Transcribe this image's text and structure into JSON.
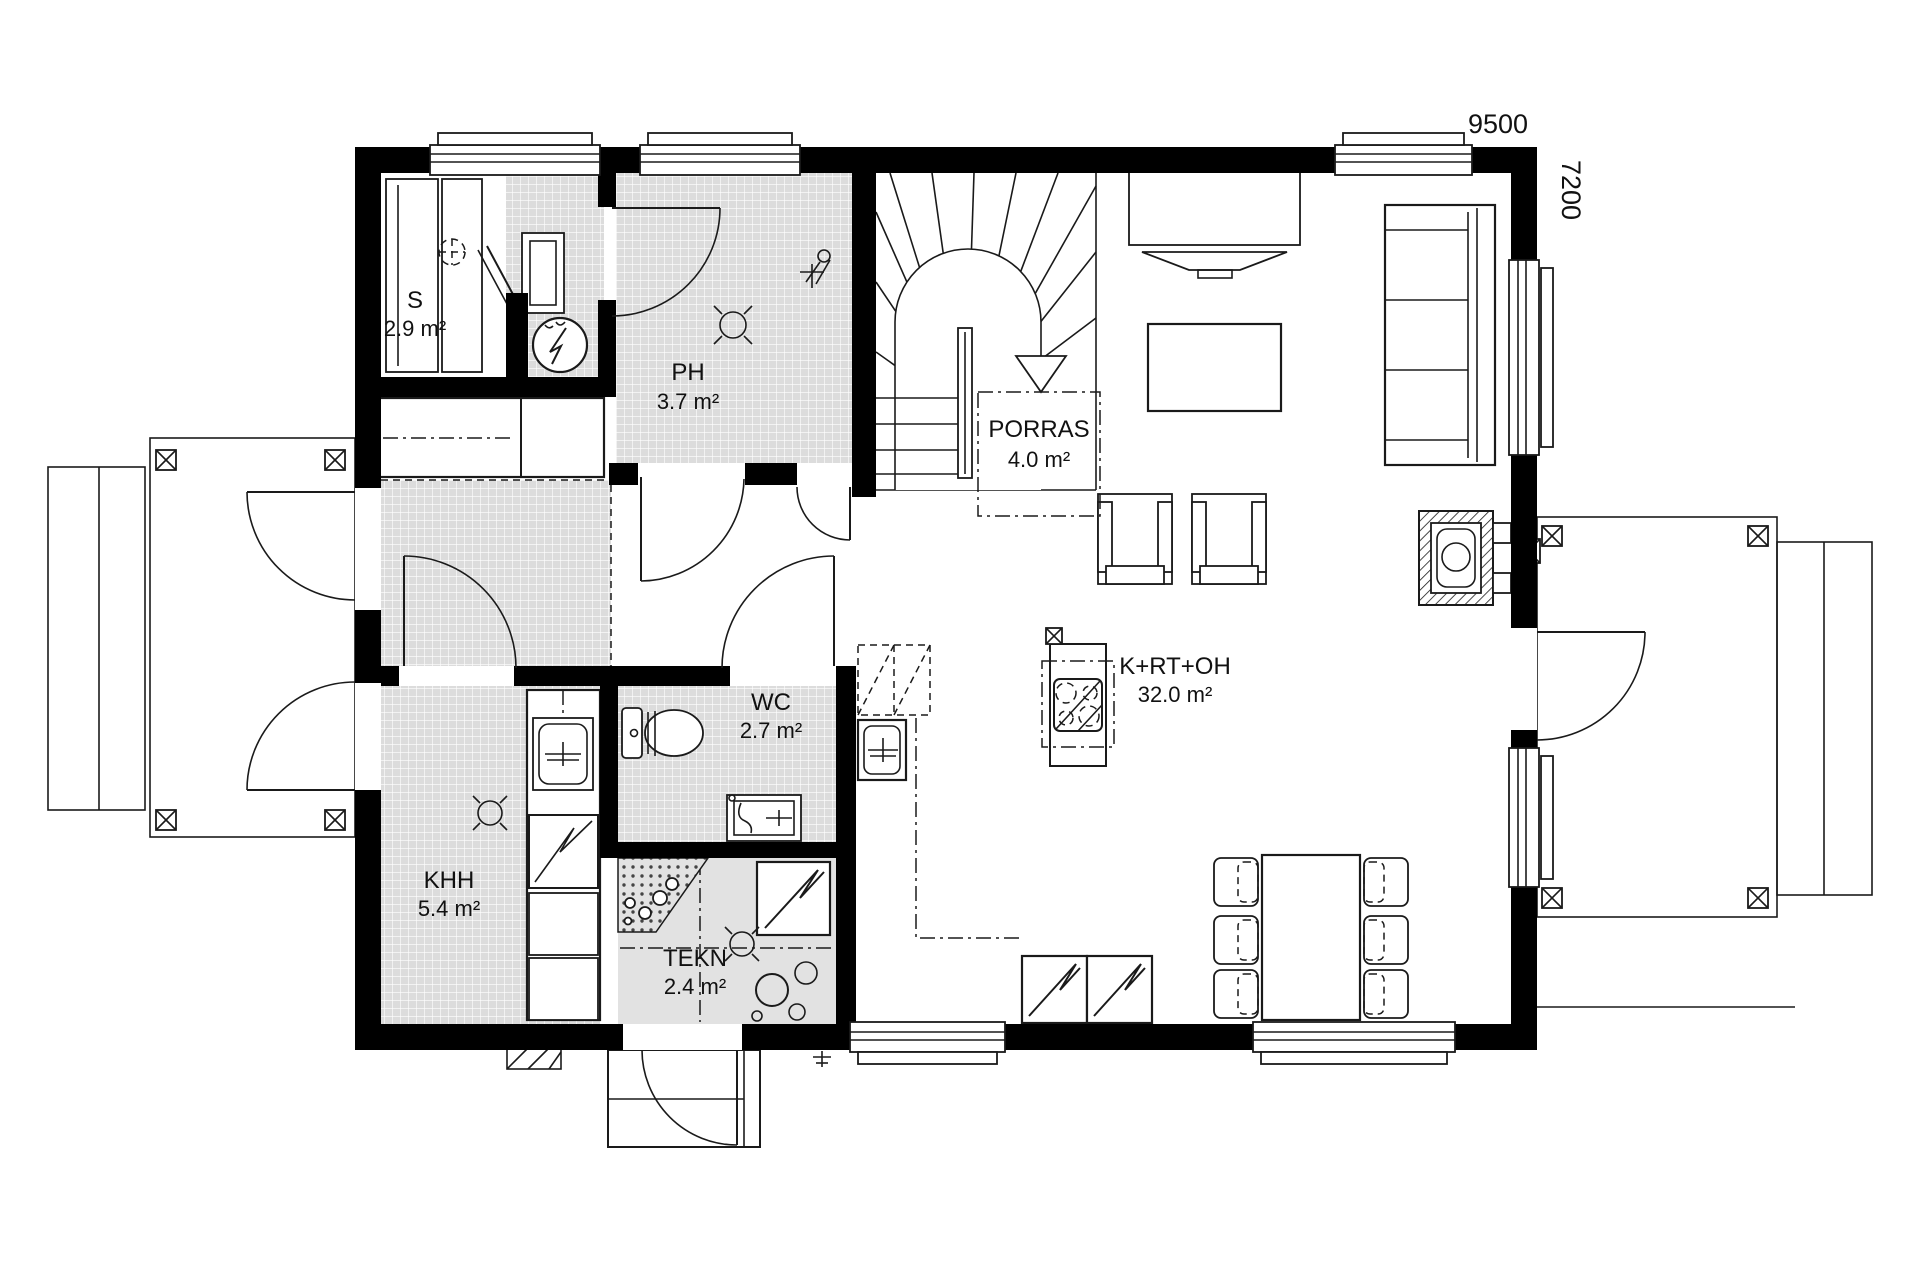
{
  "plan": {
    "type": "floor-plan",
    "dimensions": {
      "width_label": "9500",
      "height_label": "7200"
    },
    "rooms": [
      {
        "id": "sauna",
        "label": "S",
        "area": "2.9 m²"
      },
      {
        "id": "bathroom",
        "label": "PH",
        "area": "3.7 m²"
      },
      {
        "id": "staircase",
        "label": "PORRAS",
        "area": "4.0 m²"
      },
      {
        "id": "wc",
        "label": "WC",
        "area": "2.7 m²"
      },
      {
        "id": "utility",
        "label": "KHH",
        "area": "5.4 m²"
      },
      {
        "id": "technical",
        "label": "TEKN",
        "area": "2.4 m²"
      },
      {
        "id": "living-kitchen",
        "label": "K+RT+OH",
        "area": "32.0 m²"
      }
    ],
    "colors": {
      "wall": "#000000",
      "tile_floor": "#dcdcdc",
      "technical_floor": "#e2e2e2",
      "background": "#ffffff",
      "line": "#1a1a1a"
    }
  }
}
